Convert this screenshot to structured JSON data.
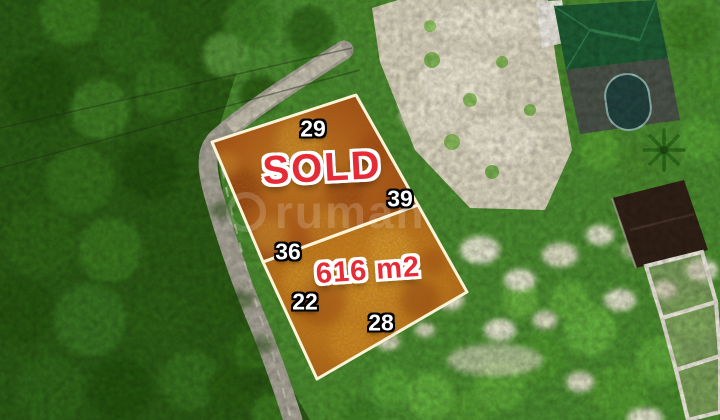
{
  "image": {
    "type": "aerial-drone-photo",
    "description": "Top-down drone view of a highlighted land parcel for sale, surrounded by forest, a road, cleared limestone lots and villas"
  },
  "listing": {
    "status_label": "SOLD",
    "area_label": "616 m2",
    "side_lengths": {
      "north": "29",
      "east": "39",
      "middle": "36",
      "west": "22",
      "south": "28"
    }
  },
  "watermark": {
    "text": "rumah"
  },
  "colors": {
    "status_red": "#e52b35",
    "label_white": "#ffffff",
    "boundary_cream": "#fdf3d7",
    "plot_orange_upper": "#a85312",
    "plot_orange_lower": "#c07a16",
    "forest_green": "#2b5a14",
    "cleared_beige": "#d8d2bc",
    "road_gray": "#a6a295"
  }
}
